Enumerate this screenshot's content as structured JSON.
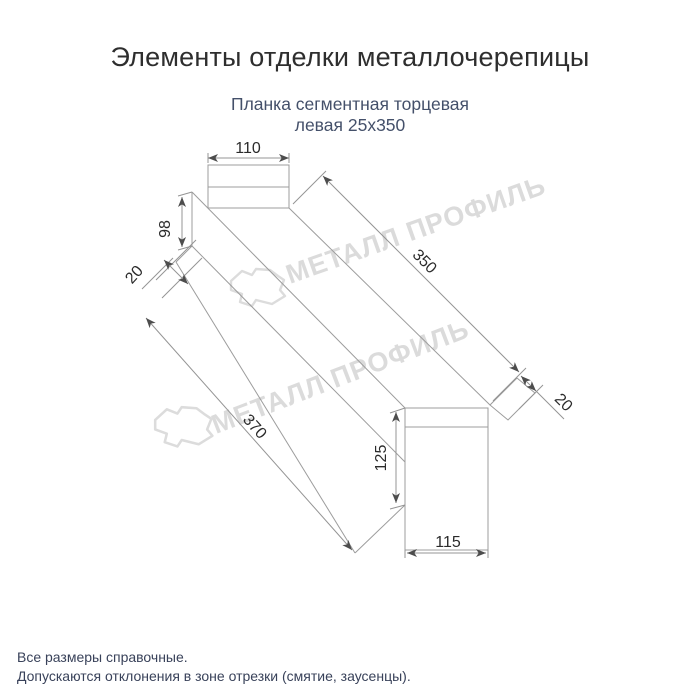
{
  "title": "Элементы отделки металлочерепицы",
  "subtitle": {
    "line1": "Планка сегментная торцевая",
    "line2": "левая 25х350"
  },
  "watermark": {
    "text": "МЕТАЛЛ ПРОФИЛЬ",
    "color": "#dbdbdb"
  },
  "dimensions": {
    "top_width": "110",
    "left_edge": "98",
    "left_flange": "20",
    "length_outer": "350",
    "right_flange": "20",
    "length_inner": "370",
    "end_height": "125",
    "end_width": "115"
  },
  "footer": {
    "line1": "Все размеры справочные.",
    "line2": "Допускаются отклонения в зоне отрезки (смятие, заусенцы)."
  },
  "colors": {
    "line_gray": "#9c9c9c",
    "text_dark": "#2b2b2b",
    "subtitle_navy": "#44506a",
    "watermark_gray": "#dbdbdb",
    "background": "#ffffff"
  }
}
